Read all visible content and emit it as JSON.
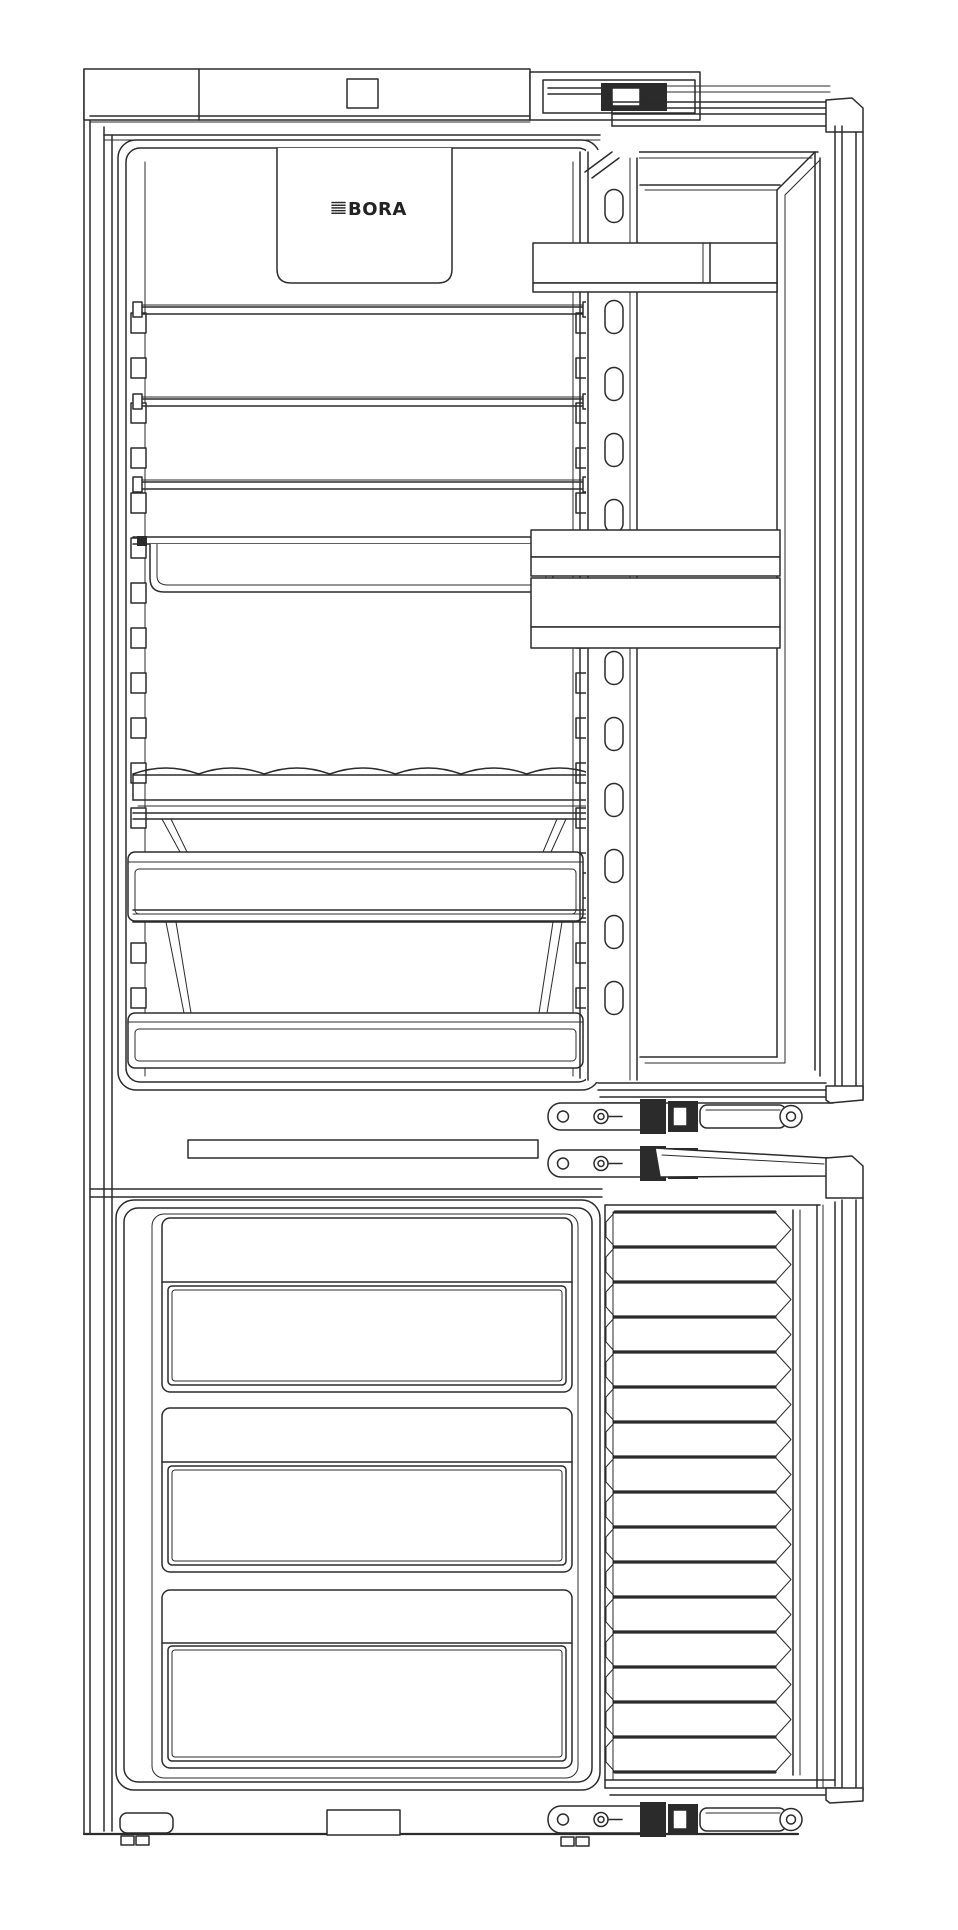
{
  "diagram": {
    "type": "technical-line-drawing",
    "subject": "Built-in fridge-freezer combination, front view, both doors open",
    "brand": "BORA",
    "line_color": "#2b2b2b",
    "background_color": "#ffffff",
    "fridge": {
      "shelves": 3,
      "support_slots_per_rail": 16,
      "pullout_tray": 1,
      "bottle_rack_scallops": 7,
      "crisper_drawers": 2,
      "door_bins": 3,
      "door_rail_slots": 11
    },
    "freezer": {
      "drawers": 3,
      "door_ribs": 16
    },
    "hinges": {
      "top_slider": 1,
      "middle_sliders": 2,
      "bottom_slider": 1
    }
  }
}
